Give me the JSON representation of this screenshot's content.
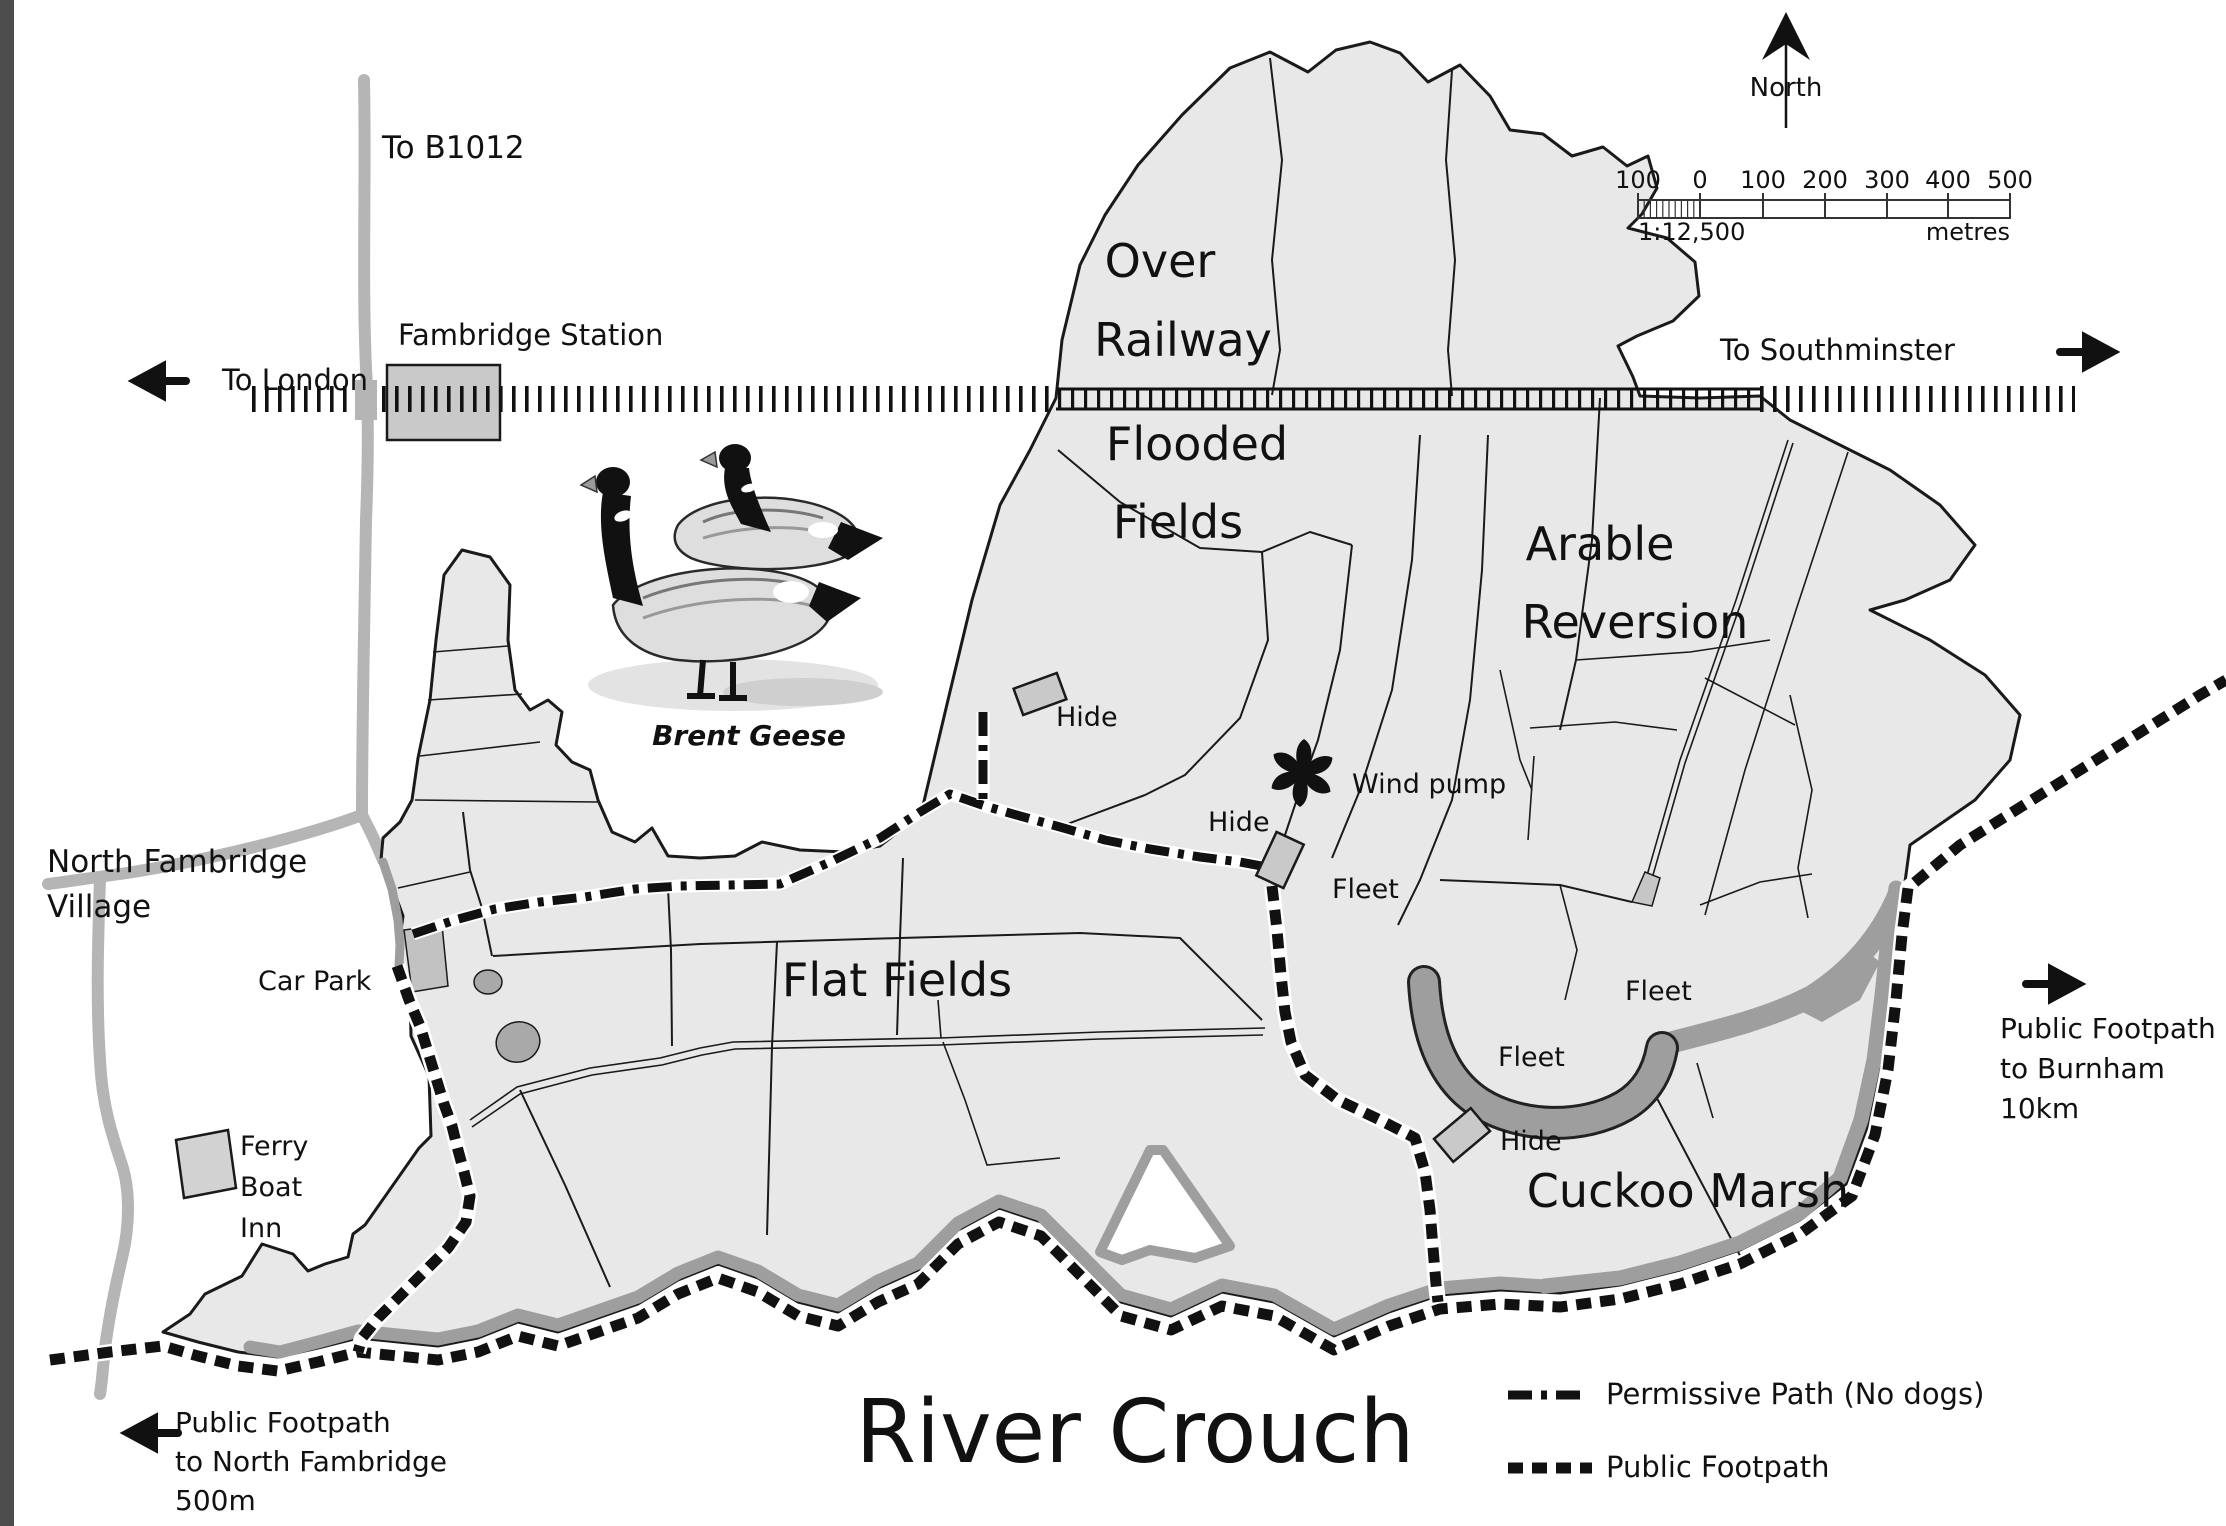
{
  "colors": {
    "page": "#ffffff",
    "edge": "#4d4d4d",
    "land": "#e8e8e8",
    "line": "#1a1a1a",
    "road": "#b5b5b5",
    "marsh": "#9e9e9e",
    "building": "#c9c9c9",
    "ink": "#111111"
  },
  "title": {
    "text": "River Crouch"
  },
  "compass": {
    "label": "North"
  },
  "scalebar": {
    "ticks": [
      "100",
      "0",
      "100",
      "200",
      "300",
      "400",
      "500"
    ],
    "ratio": "1:12,500",
    "unit": "metres"
  },
  "legend": {
    "permissive": "Permissive Path (No dogs)",
    "footpath": "Public Footpath"
  },
  "railway": {
    "to_london": "To London",
    "to_southminster": "To Southminster",
    "station": "Fambridge Station"
  },
  "roads": {
    "to_b1012": "To B1012"
  },
  "areas": {
    "over": "Over",
    "railway": "Railway",
    "flooded": "Flooded",
    "fields": "Fields",
    "arable": "Arable",
    "reversion": "Reversion",
    "flat_fields": "Flat Fields",
    "cuckoo_marsh": "Cuckoo Marsh"
  },
  "features": {
    "hide": "Hide",
    "fleet": "Fleet",
    "wind_pump": "Wind pump",
    "car_park": "Car Park",
    "brent_geese": "Brent Geese"
  },
  "village": {
    "line1": "North Fambridge",
    "line2": "Village"
  },
  "ferry": {
    "line1": "Ferry",
    "line2": "Boat",
    "line3": "Inn"
  },
  "notes": {
    "north_fambridge": {
      "line1": "Public Footpath",
      "line2": "to North Fambridge",
      "line3": "500m"
    },
    "burnham": {
      "line1": "Public Footpath",
      "line2": "to Burnham",
      "line3": "10km"
    }
  }
}
